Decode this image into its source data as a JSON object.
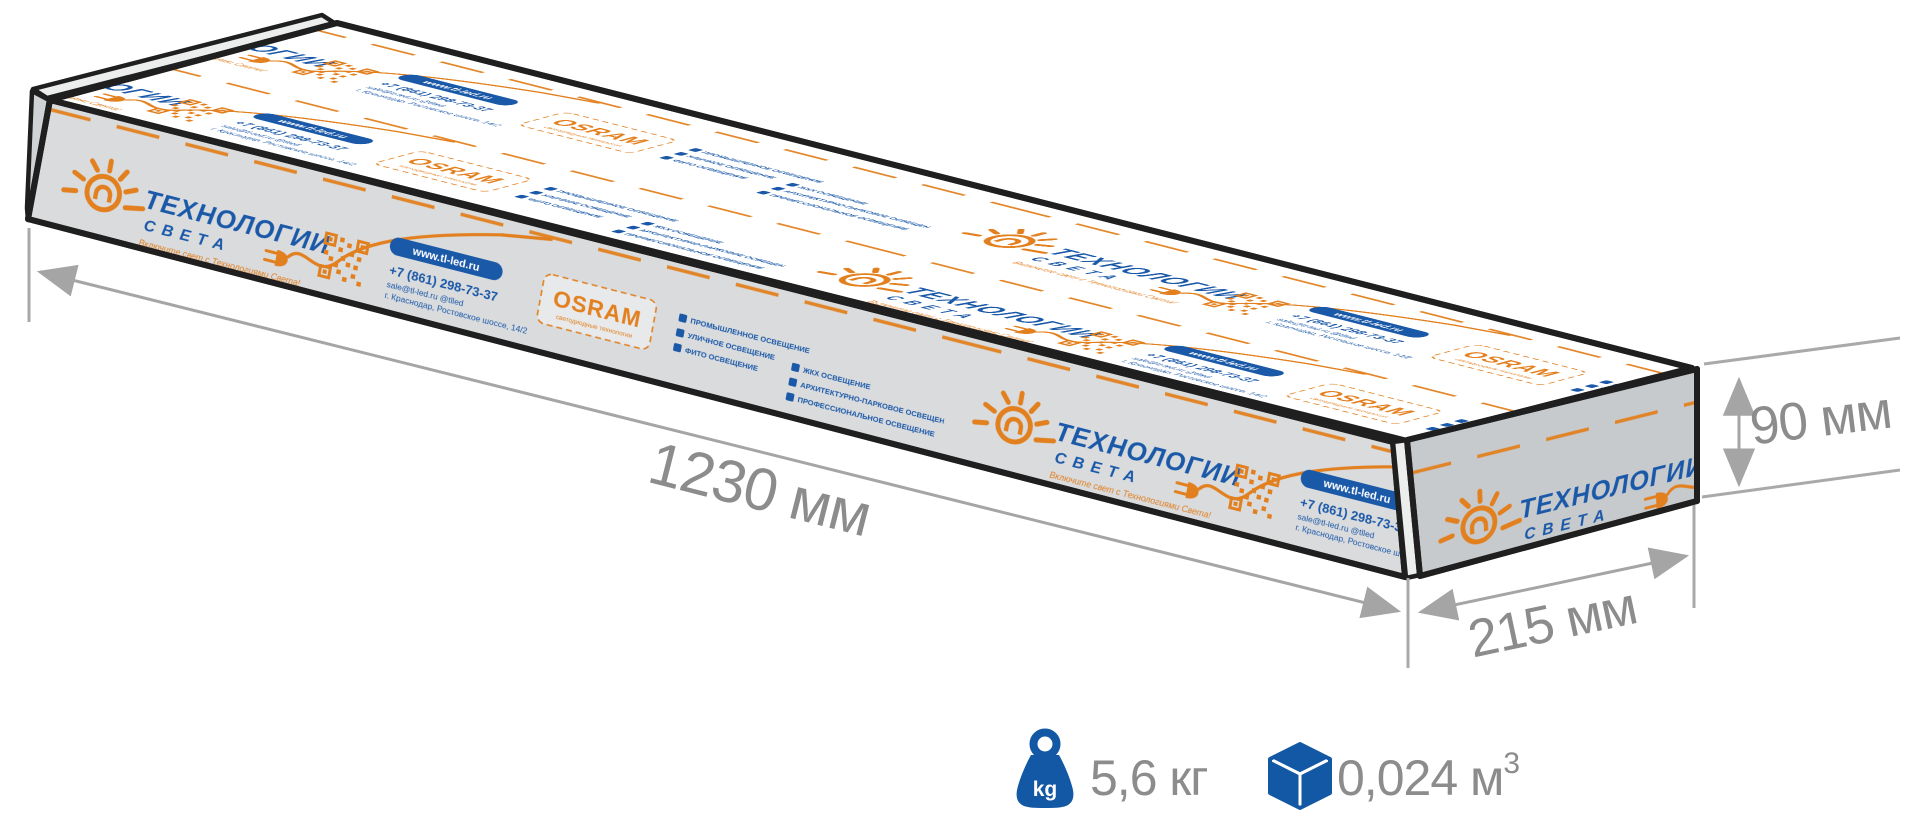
{
  "diagram": {
    "length_label": "1230 мм",
    "height_label": "90 мм",
    "depth_label": "215 мм",
    "weight_label": "5,6 кг",
    "weight_icon_text": "kg",
    "volume_value": "0,024 м",
    "volume_sup": "3"
  },
  "packaging": {
    "brand_line1": "ТЕХНОЛОГИИ",
    "brand_line2": "СВЕТА",
    "tagline": "Включите свет с Технологиями Света!",
    "website": "www.tl-led.ru",
    "phone": "+7 (861) 298-73-37",
    "email_line": "sale@tl-led.ru    @tlled",
    "address_line": "г. Краснодар, Ростовское шоссе, 14/2",
    "osram": "OSRAM",
    "osram_sub": "светодиодные технологии",
    "services_a": [
      "ЖКХ ОСВЕЩЕНИЕ",
      "АРХИТЕКТУРНО-ПАРКОВОЕ ОСВЕЩЕНИЕ",
      "ПРОФЕССИОНАЛЬНОЕ ОСВЕЩЕНИЕ"
    ],
    "services_b": [
      "ПРОМЫШЛЕННОЕ ОСВЕЩЕНИЕ",
      "УЛИЧНОЕ ОСВЕЩЕНИЕ",
      "ФИТО ОСВЕЩЕНИЕ"
    ]
  },
  "colors": {
    "brand_orange": "#E2801F",
    "brand_blue": "#1A58A8",
    "info_blue": "#1358A5",
    "dimension_text_gray": "#8C8C8C",
    "dimension_line_gray": "#A5A5A5",
    "face_top": "#FFFFFF",
    "face_front": "#D9DBDD",
    "face_end": "#C7CACD"
  }
}
